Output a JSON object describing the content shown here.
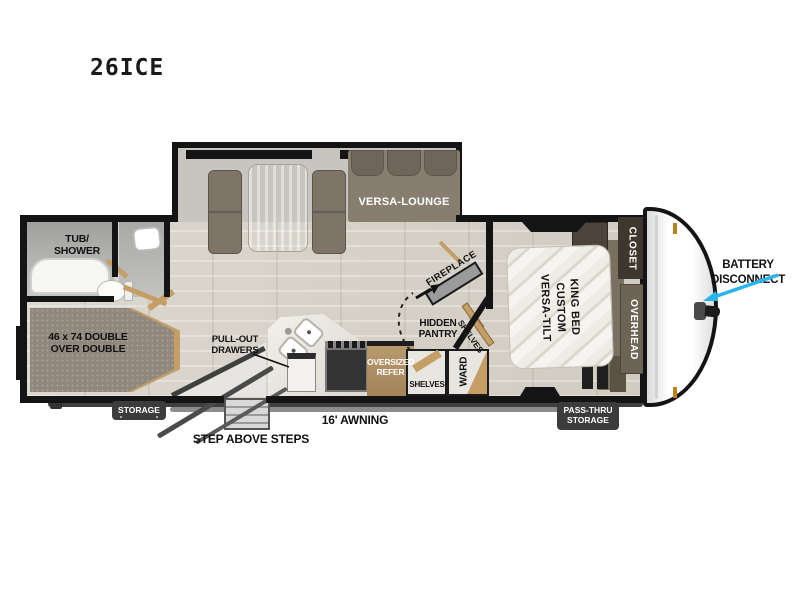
{
  "title": "26ICE",
  "colors": {
    "wall": "#141414",
    "floor_wood": "#d8d4ca",
    "sofa": "#7e7568",
    "wood_trim": "#c59e66",
    "refer": "#b08f63",
    "badge": "#3c3c3c",
    "battery_arrow": "#2ab5ea",
    "marker_light": "#b8821e"
  },
  "labels": {
    "versa_lounge": "VERSA-LOUNGE",
    "tub_1": "TUB/",
    "tub_2": "SHOWER",
    "bunk_1": "46 x 74 DOUBLE",
    "bunk_2": "OVER DOUBLE",
    "pullout_1": "PULL-OUT",
    "pullout_2": "DRAWERS",
    "fireplace": "FIREPLACE",
    "pantry_1": "HIDDEN",
    "pantry_2": "PANTRY",
    "shelves_diag": "SHELVES",
    "shelves": "SHELVES",
    "ward": "WARD",
    "refer_1": "OVERSIZED",
    "refer_2": "REFER",
    "storage": "STORAGE",
    "steps": "STEP ABOVE STEPS",
    "awning": "16' AWNING",
    "passthru_1": "PASS-THRU",
    "passthru_2": "STORAGE",
    "bed_1": "VERSA-TILT",
    "bed_2": "CUSTOM",
    "bed_3": "KING BED",
    "closet": "CLOSET",
    "overhead": "OVERHEAD",
    "battery_1": "BATTERY",
    "battery_2": "DISCONNECT"
  }
}
